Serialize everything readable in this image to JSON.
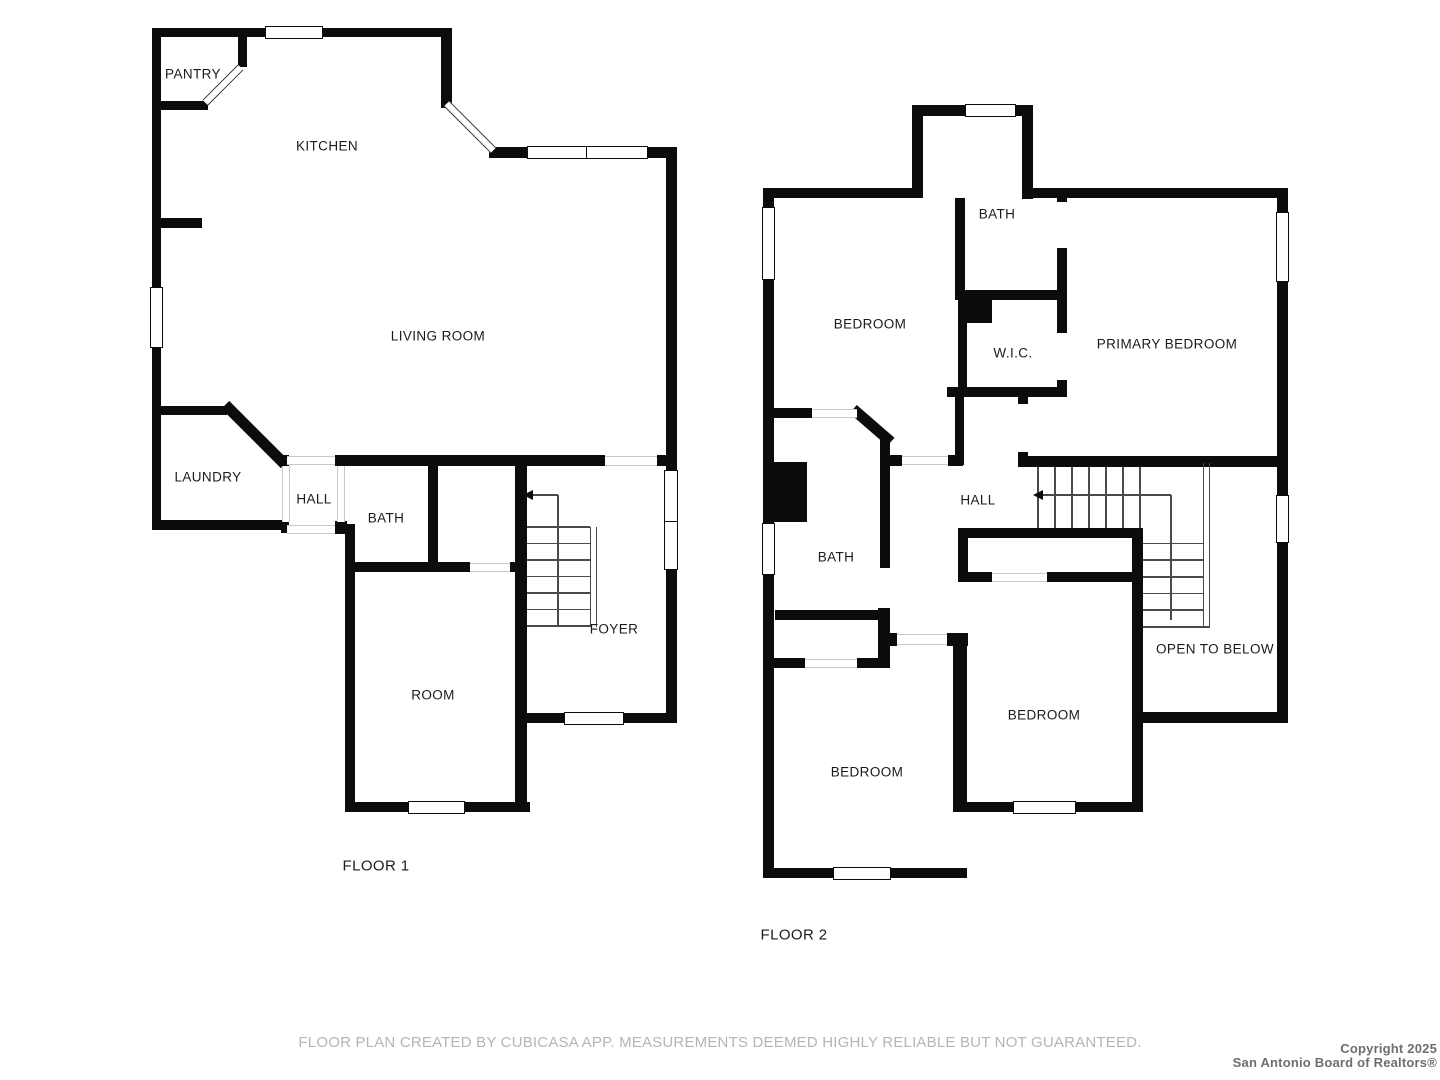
{
  "disclaimer": "FLOOR PLAN CREATED BY CUBICASA APP. MEASUREMENTS DEEMED HIGHLY RELIABLE BUT NOT GUARANTEED.",
  "copyright": {
    "line1": "Copyright 2025",
    "line2": "San Antonio Board of Realtors®"
  },
  "floors": [
    {
      "title": "FLOOR 1",
      "cx": 376,
      "cy": 866,
      "rooms": [
        "PANTRY",
        "KITCHEN",
        "LIVING ROOM",
        "LAUNDRY",
        "HALL",
        "BATH",
        "FOYER",
        "ROOM"
      ]
    },
    {
      "title": "FLOOR 2",
      "cx": 794,
      "cy": 935,
      "rooms": [
        "BATH",
        "BEDROOM",
        "W.I.C.",
        "PRIMARY BEDROOM",
        "HALL",
        "BATH",
        "BEDROOM",
        "OPEN TO BELOW",
        "BEDROOM"
      ]
    }
  ],
  "labels": [
    {
      "text": "PANTRY",
      "x": 193,
      "y": 74
    },
    {
      "text": "KITCHEN",
      "x": 327,
      "y": 146
    },
    {
      "text": "LIVING ROOM",
      "x": 438,
      "y": 336
    },
    {
      "text": "LAUNDRY",
      "x": 208,
      "y": 477
    },
    {
      "text": "HALL",
      "x": 314,
      "y": 499
    },
    {
      "text": "BATH",
      "x": 386,
      "y": 518
    },
    {
      "text": "FOYER",
      "x": 614,
      "y": 629
    },
    {
      "text": "ROOM",
      "x": 433,
      "y": 695
    },
    {
      "text": "BATH",
      "x": 997,
      "y": 214
    },
    {
      "text": "BEDROOM",
      "x": 870,
      "y": 324
    },
    {
      "text": "W.I.C.",
      "x": 1013,
      "y": 353
    },
    {
      "text": "PRIMARY BEDROOM",
      "x": 1167,
      "y": 344
    },
    {
      "text": "HALL",
      "x": 978,
      "y": 500
    },
    {
      "text": "BATH",
      "x": 836,
      "y": 557
    },
    {
      "text": "OPEN TO BELOW",
      "x": 1215,
      "y": 649
    },
    {
      "text": "BEDROOM",
      "x": 1044,
      "y": 715
    },
    {
      "text": "BEDROOM",
      "x": 867,
      "y": 772
    }
  ],
  "geometry": {
    "wall_color": "#0c0c0c",
    "walls": [
      [
        152,
        28,
        9,
        502
      ],
      [
        152,
        28,
        300,
        9
      ],
      [
        238,
        28,
        9,
        39
      ],
      [
        152,
        101,
        56,
        9
      ],
      [
        441,
        28,
        11,
        80
      ],
      [
        489,
        147,
        38,
        11
      ],
      [
        648,
        147,
        29,
        11
      ],
      [
        666,
        147,
        11,
        576
      ],
      [
        160,
        218,
        42,
        10
      ],
      [
        152,
        406,
        75,
        9
      ],
      [
        152,
        520,
        131,
        10
      ],
      [
        281,
        455,
        8,
        12
      ],
      [
        281,
        521,
        8,
        12
      ],
      [
        335,
        521,
        12,
        13
      ],
      [
        335,
        455,
        270,
        11
      ],
      [
        657,
        455,
        20,
        11
      ],
      [
        428,
        465,
        10,
        102
      ],
      [
        345,
        562,
        125,
        10
      ],
      [
        510,
        562,
        12,
        10
      ],
      [
        515,
        455,
        12,
        357
      ],
      [
        345,
        524,
        10,
        288
      ],
      [
        345,
        802,
        185,
        10
      ],
      [
        518,
        713,
        157,
        10
      ],
      [
        763,
        188,
        11,
        690
      ],
      [
        763,
        188,
        150,
        10
      ],
      [
        912,
        105,
        11,
        93
      ],
      [
        912,
        105,
        121,
        11
      ],
      [
        1022,
        105,
        11,
        94
      ],
      [
        1022,
        188,
        266,
        10
      ],
      [
        1277,
        188,
        11,
        535
      ],
      [
        1140,
        712,
        148,
        11
      ],
      [
        1132,
        528,
        11,
        284
      ],
      [
        953,
        802,
        190,
        10
      ],
      [
        953,
        633,
        14,
        179
      ],
      [
        763,
        868,
        204,
        10
      ],
      [
        955,
        198,
        10,
        95
      ],
      [
        955,
        290,
        112,
        10
      ],
      [
        958,
        300,
        9,
        90
      ],
      [
        947,
        387,
        120,
        10
      ],
      [
        1057,
        190,
        10,
        12
      ],
      [
        1057,
        248,
        10,
        85
      ],
      [
        1057,
        380,
        10,
        12
      ],
      [
        955,
        395,
        9,
        70
      ],
      [
        763,
        408,
        49,
        10
      ],
      [
        880,
        438,
        10,
        130
      ],
      [
        878,
        608,
        12,
        60
      ],
      [
        880,
        455,
        22,
        11
      ],
      [
        948,
        455,
        15,
        11
      ],
      [
        1018,
        395,
        10,
        9
      ],
      [
        1018,
        452,
        10,
        13
      ],
      [
        1018,
        456,
        270,
        11
      ],
      [
        775,
        610,
        107,
        10
      ],
      [
        880,
        633,
        17,
        13
      ],
      [
        947,
        633,
        21,
        13
      ],
      [
        763,
        658,
        42,
        10
      ],
      [
        857,
        658,
        31,
        10
      ],
      [
        958,
        528,
        175,
        10
      ],
      [
        958,
        528,
        10,
        54
      ],
      [
        958,
        572,
        34,
        10
      ],
      [
        1047,
        572,
        86,
        10
      ]
    ],
    "solids": [
      [
        763,
        462,
        44,
        60
      ],
      [
        958,
        295,
        34,
        28
      ]
    ],
    "diagonal_walls": [
      {
        "cx": 255,
        "cy": 434,
        "len": 84,
        "th": 11,
        "ang": 45
      },
      {
        "cx": 872,
        "cy": 425,
        "len": 50,
        "th": 11,
        "ang": 41
      }
    ],
    "diagonal_openings": [
      {
        "cx": 223,
        "cy": 85,
        "len": 50,
        "th": 8,
        "ang": -45
      },
      {
        "cx": 470,
        "cy": 127,
        "len": 66,
        "th": 8,
        "ang": 45
      }
    ],
    "windows": [
      {
        "x": 265,
        "y": 26,
        "w": 58,
        "h": 13
      },
      {
        "x": 527,
        "y": 146,
        "w": 121,
        "h": 13,
        "d": 0.48
      },
      {
        "x": 150,
        "y": 287,
        "w": 13,
        "h": 61
      },
      {
        "x": 664,
        "y": 470,
        "w": 14,
        "h": 100,
        "d": 0.5
      },
      {
        "x": 564,
        "y": 712,
        "w": 60,
        "h": 13
      },
      {
        "x": 408,
        "y": 801,
        "w": 57,
        "h": 13
      },
      {
        "x": 762,
        "y": 207,
        "w": 13,
        "h": 73
      },
      {
        "x": 762,
        "y": 523,
        "w": 13,
        "h": 52
      },
      {
        "x": 965,
        "y": 104,
        "w": 51,
        "h": 13
      },
      {
        "x": 1276,
        "y": 212,
        "w": 13,
        "h": 70
      },
      {
        "x": 1276,
        "y": 495,
        "w": 13,
        "h": 48
      },
      {
        "x": 1013,
        "y": 801,
        "w": 63,
        "h": 13
      },
      {
        "x": 833,
        "y": 867,
        "w": 58,
        "h": 13
      }
    ],
    "openings": [
      {
        "x": 605,
        "y": 456,
        "w": 52,
        "h": 10,
        "o": "h"
      },
      {
        "x": 470,
        "y": 563,
        "w": 40,
        "h": 9,
        "o": "h"
      },
      {
        "x": 287,
        "y": 456,
        "w": 48,
        "h": 9,
        "o": "h"
      },
      {
        "x": 287,
        "y": 525,
        "w": 48,
        "h": 9,
        "o": "h"
      },
      {
        "x": 282,
        "y": 466,
        "w": 8,
        "h": 56,
        "o": "v"
      },
      {
        "x": 337,
        "y": 466,
        "w": 8,
        "h": 56,
        "o": "v"
      },
      {
        "x": 812,
        "y": 409,
        "w": 45,
        "h": 9,
        "o": "h"
      },
      {
        "x": 902,
        "y": 456,
        "w": 46,
        "h": 9,
        "o": "h"
      },
      {
        "x": 897,
        "y": 634,
        "w": 50,
        "h": 11,
        "o": "h"
      },
      {
        "x": 805,
        "y": 659,
        "w": 52,
        "h": 9,
        "o": "h"
      },
      {
        "x": 992,
        "y": 573,
        "w": 55,
        "h": 9,
        "o": "h"
      }
    ],
    "stair_lines": [
      [
        527,
        527,
        590,
        527
      ],
      [
        527,
        543.5,
        590,
        543.5
      ],
      [
        527,
        560,
        590,
        560
      ],
      [
        527,
        576.5,
        590,
        576.5
      ],
      [
        527,
        593,
        590,
        593
      ],
      [
        527,
        609.5,
        590,
        609.5
      ],
      [
        527,
        626,
        590,
        626
      ],
      [
        1038,
        467,
        1038,
        528
      ],
      [
        1055,
        467,
        1055,
        528
      ],
      [
        1072,
        467,
        1072,
        528
      ],
      [
        1089,
        467,
        1089,
        528
      ],
      [
        1106,
        467,
        1106,
        528
      ],
      [
        1123,
        467,
        1123,
        528
      ],
      [
        1140,
        467,
        1140,
        528
      ],
      [
        1143,
        543.5,
        1203,
        543.5
      ],
      [
        1143,
        560,
        1203,
        560
      ],
      [
        1143,
        577,
        1203,
        577
      ],
      [
        1143,
        593.5,
        1203,
        593.5
      ],
      [
        1143,
        610,
        1203,
        610
      ],
      [
        1143,
        627,
        1210,
        627
      ]
    ],
    "arrow_lines": [
      [
        532,
        495,
        558,
        495
      ],
      [
        558,
        495,
        558,
        626
      ],
      [
        1042,
        495,
        1171,
        495
      ],
      [
        1171,
        495,
        1171,
        620
      ]
    ],
    "stringers": [
      [
        590,
        527,
        7,
        100
      ],
      [
        1203,
        463,
        7,
        165
      ]
    ],
    "arrowheads": [
      {
        "x": 523,
        "y": 490
      },
      {
        "x": 1033,
        "y": 490
      }
    ]
  }
}
